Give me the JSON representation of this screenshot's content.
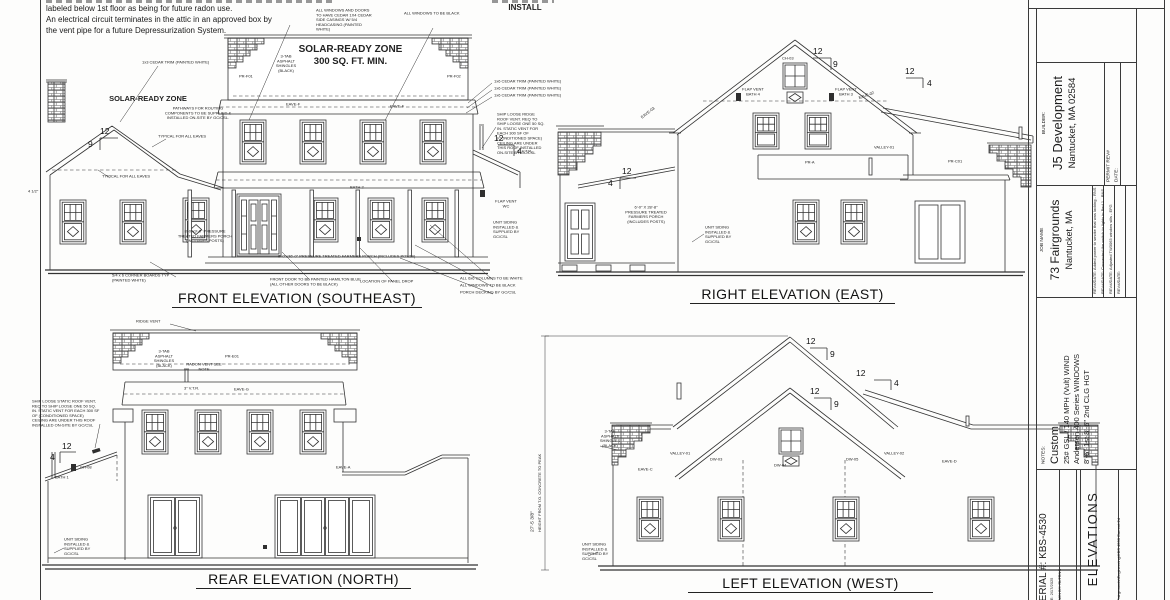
{
  "notes": {
    "line1": "labeled below 1st floor as being for future radon use.",
    "line2": "An electrical circuit terminates in the attic in an approved box by",
    "line3": "the vent pipe for a future Depressurization System."
  },
  "install": {
    "label": "INSTALL"
  },
  "pitch": {
    "n12": "12",
    "n9": "9",
    "n4": "4"
  },
  "shared": {
    "siding": "UNIT SIDING INSTALLED & SUPPLIED BY GC/CSL",
    "shingles": "3-TAB ASPHALT SHINGLES (BLACK)",
    "vtr": "3\" V.T.R.",
    "typ_eaves": "TYPICAL FOR ALL EAVES"
  },
  "front": {
    "title": "FRONT ELEVATION (SOUTHEAST)",
    "solar_left": "SOLAR-READY ZONE",
    "solar_left_sub": "PATHWAYS FOR ROUTING COMPONENTS TO BE SUPPLIED & INSTALLED ON-SITE BY GC/CSL.",
    "solar_main": "SOLAR-READY ZONE",
    "solar_main_sub": "300 SQ. FT. MIN.",
    "cedar13": "1x3 CEDAR TRIM (PAINTED WHITE)",
    "casing_note": "ALL WINDOWS AND DOORS TO HAVE CEDAR 1X4 CEDAR SIDE CASINGS W/ 5/4 HEADCASING (PAINTED WHITE)",
    "windows_black": "ALL WINDOWS TO BE BLACK",
    "cedar16": "1x6 CEDAR TRIM (PAINTED WHITE)",
    "ship_loose": "SHIP LOOSE RIDGE ROOF VENT. REQ TO SHIP LOOSE ONE 50 SQ. IN. STATIC VENT FOR EACH 300 SF OF (CONDITIONED SPACE) CEILING ARE UNDER THIS ROOF INSTALLED ON-SITE BY GC/CSL",
    "flap_wc": "FLAP VENT WC",
    "half": "4 1/2\"",
    "porch_small": "8'-0\"x9'-0\" PRESSURE TREATED FARMERS PORCH (INCLUDES POSTS)",
    "corner_boards": "5/4 x 6 CORNER BOARDS TYP (PAINTED WHITE)",
    "door_note": "FRONT DOOR TO BE PAINTED HAMILTON BLUE (ALL OTHER DOORS TO BE BLACK)",
    "porch_long": "8'-0\"x36'-0\" PRESSURE TREATED FARMERS PORCH (INCLUDES POSTS)",
    "panel_drop": "LOCATION OF PANEL DROP",
    "columns": "ALL 6x6 COLUMNS TO BE WHITE",
    "decking": "PORCH DECKING BY GC/CSL",
    "eave_f": "EAVE-F",
    "pr_f01": "PR-F01",
    "pr_f02": "PR-F02",
    "bath2": "BATH 2"
  },
  "right": {
    "title": "RIGHT ELEVATION (EAST)",
    "flap_b4": "FLAP VENT BATH 4",
    "flap_b3": "FLAP VENT BATH 3",
    "ch03": "CH-03",
    "valley01": "VALLEY-01",
    "pr_a": "PR-A",
    "pr_c01": "PR-C01",
    "eave03": "EAVE-03",
    "eave02": "EAVE-02",
    "porch": "6'-0\" X 28'-8\" PRESSURE TREATED FARMERS PORCH (INCLUDES POSTS)"
  },
  "rear": {
    "title": "REAR ELEVATION (NORTH)",
    "ridge_vent": "RIDGE VENT",
    "radon": "RADON VENT SEE NOTE",
    "pr_e01": "PR-E01",
    "eave_g": "EAVE-G",
    "eave_a": "EAVE-A",
    "ship_loose": "SHIP LOOSE STATIC ROOF VENT, REQ TO SHIP LOOSE ONE 50 SQ. IN. STATIC VENT FOR EACH 300 SF OF (CONDITIONED SPACE) CEILING ARE UNDER THIS ROOF INSTALLED ON-SITE BY GC/CSL",
    "bath1": "BATH 1",
    "ch08": "CH-08"
  },
  "left": {
    "title": "LEFT ELEVATION (WEST)",
    "dim": "27'-5 3/8\"",
    "dim_sub": "HEIGHT FROM T.O. CONCRETE TO PEAK",
    "valley01": "VALLEY-01",
    "valley02": "VALLEY-02",
    "eave_c": "EAVE-C",
    "eave_d": "EAVE-D",
    "dw03": "DW-03",
    "dw04": "DW-04",
    "dw05": "DW-05"
  },
  "title_block": {
    "builder_label": "BUILDER:",
    "builder_name": "J5 Development",
    "builder_city": "Nantucket, MA 02584",
    "permit": "PERMIT REV#",
    "permit_date": "DATE:",
    "job_label": "JOB NAME",
    "job_name": "73 Fairgrounds",
    "job_city": "Nantucket, MA",
    "rev1": "REV#/DATE: Added power to smoke that was lacking - RNS",
    "rev2": "REV#/DATE: Connected the switch to lights in Bed 1 - RNS",
    "rev3": "REV#/DATE: Adjusted TW3063 window sills - EFG",
    "rev4": "REV#/DATE:",
    "notes_label": "NOTES:",
    "note1": "Custom",
    "note2": "25# GSL / 140 MPH (Vult) WIND",
    "note3": "Andersen 400 Series WINDOWS",
    "note4": "8'-6\" 1st 8'-6\" 2nd CLG HGT",
    "serial": "SERIAL #: KBS-4530",
    "date": "DATE: 2/17/2025",
    "drawn": "DRAWN BY: RLTRNS",
    "sheet": "ELEVATIONS",
    "path": "Fairgrounds\\Engineering\\KBS 4530 Current.2d"
  }
}
